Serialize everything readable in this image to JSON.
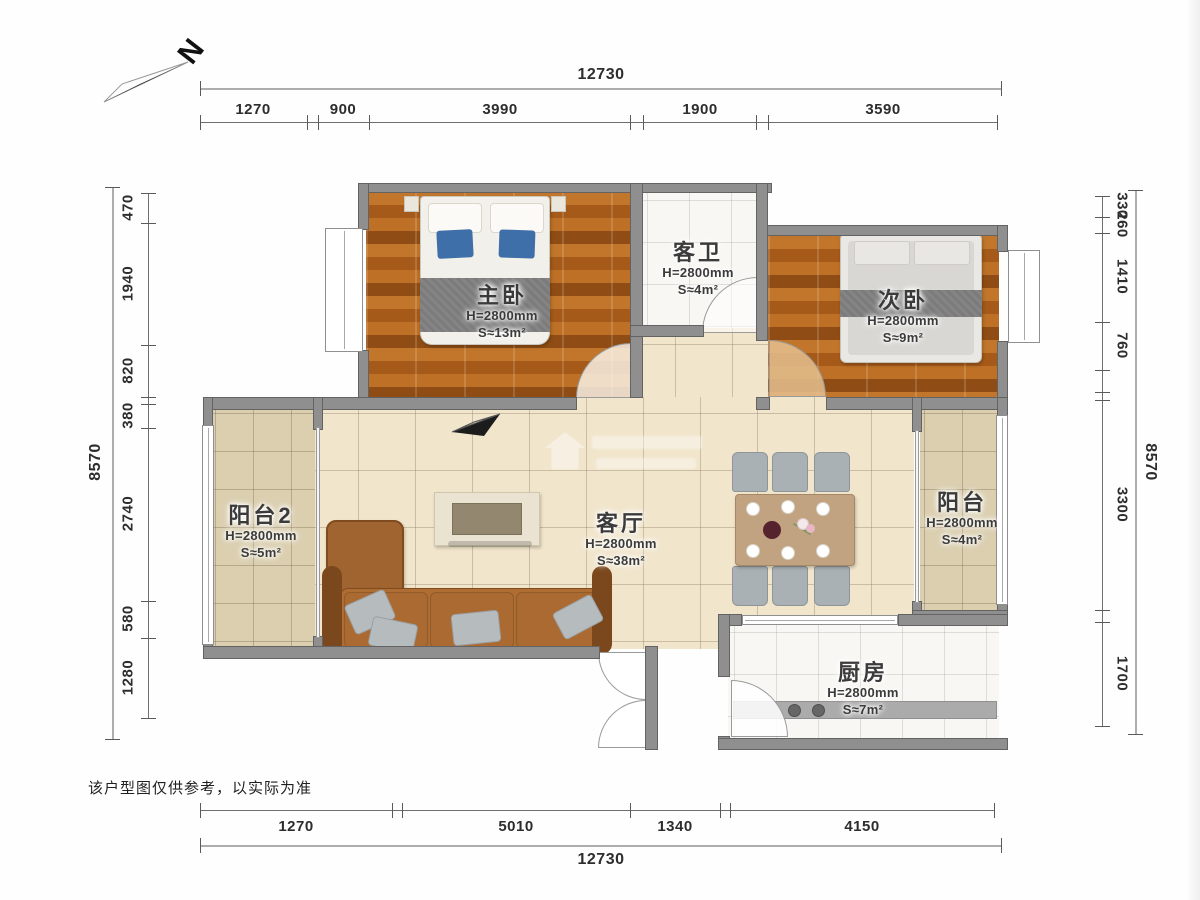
{
  "compass": {
    "label": "N"
  },
  "disclaimer": "该户型图仅供参考，以实际为准",
  "dimensions": {
    "top": {
      "total": "12730",
      "segments": [
        "1270",
        "900",
        "3990",
        "1900",
        "3590"
      ]
    },
    "bottom": {
      "total": "12730",
      "segments": [
        "1270",
        "5010",
        "1340",
        "4150"
      ]
    },
    "left": {
      "total": "8570",
      "segments": [
        "470",
        "1940",
        "820",
        "380",
        "2740",
        "580",
        "1280"
      ]
    },
    "right": {
      "total": "8570",
      "segments": [
        "330",
        "260",
        "1410",
        "760",
        "3300",
        "1700"
      ]
    }
  },
  "rooms": {
    "master_bedroom": {
      "name": "主卧",
      "height": "H=2800mm",
      "area": "S≈13m²"
    },
    "guest_bathroom": {
      "name": "客卫",
      "height": "H=2800mm",
      "area": "S≈4m²"
    },
    "second_bedroom": {
      "name": "次卧",
      "height": "H=2800mm",
      "area": "S≈9m²"
    },
    "balcony2": {
      "name": "阳台2",
      "height": "H=2800mm",
      "area": "S≈5m²"
    },
    "living_room": {
      "name": "客厅",
      "height": "H=2800mm",
      "area": "S≈38m²"
    },
    "balcony": {
      "name": "阳台",
      "height": "H=2800mm",
      "area": "S≈4m²"
    },
    "kitchen": {
      "name": "厨房",
      "height": "H=2800mm",
      "area": "S≈7m²"
    }
  },
  "colors": {
    "wall": "#8f8f8f",
    "wood_floor": "#b2671e",
    "living_tile": "#f1e5cc",
    "balcony_tile": "#dbcfb0",
    "pillow_blue": "#3f6fa8",
    "sofa_brown": "#a8692f",
    "dim_text": "#2d2d2d"
  }
}
